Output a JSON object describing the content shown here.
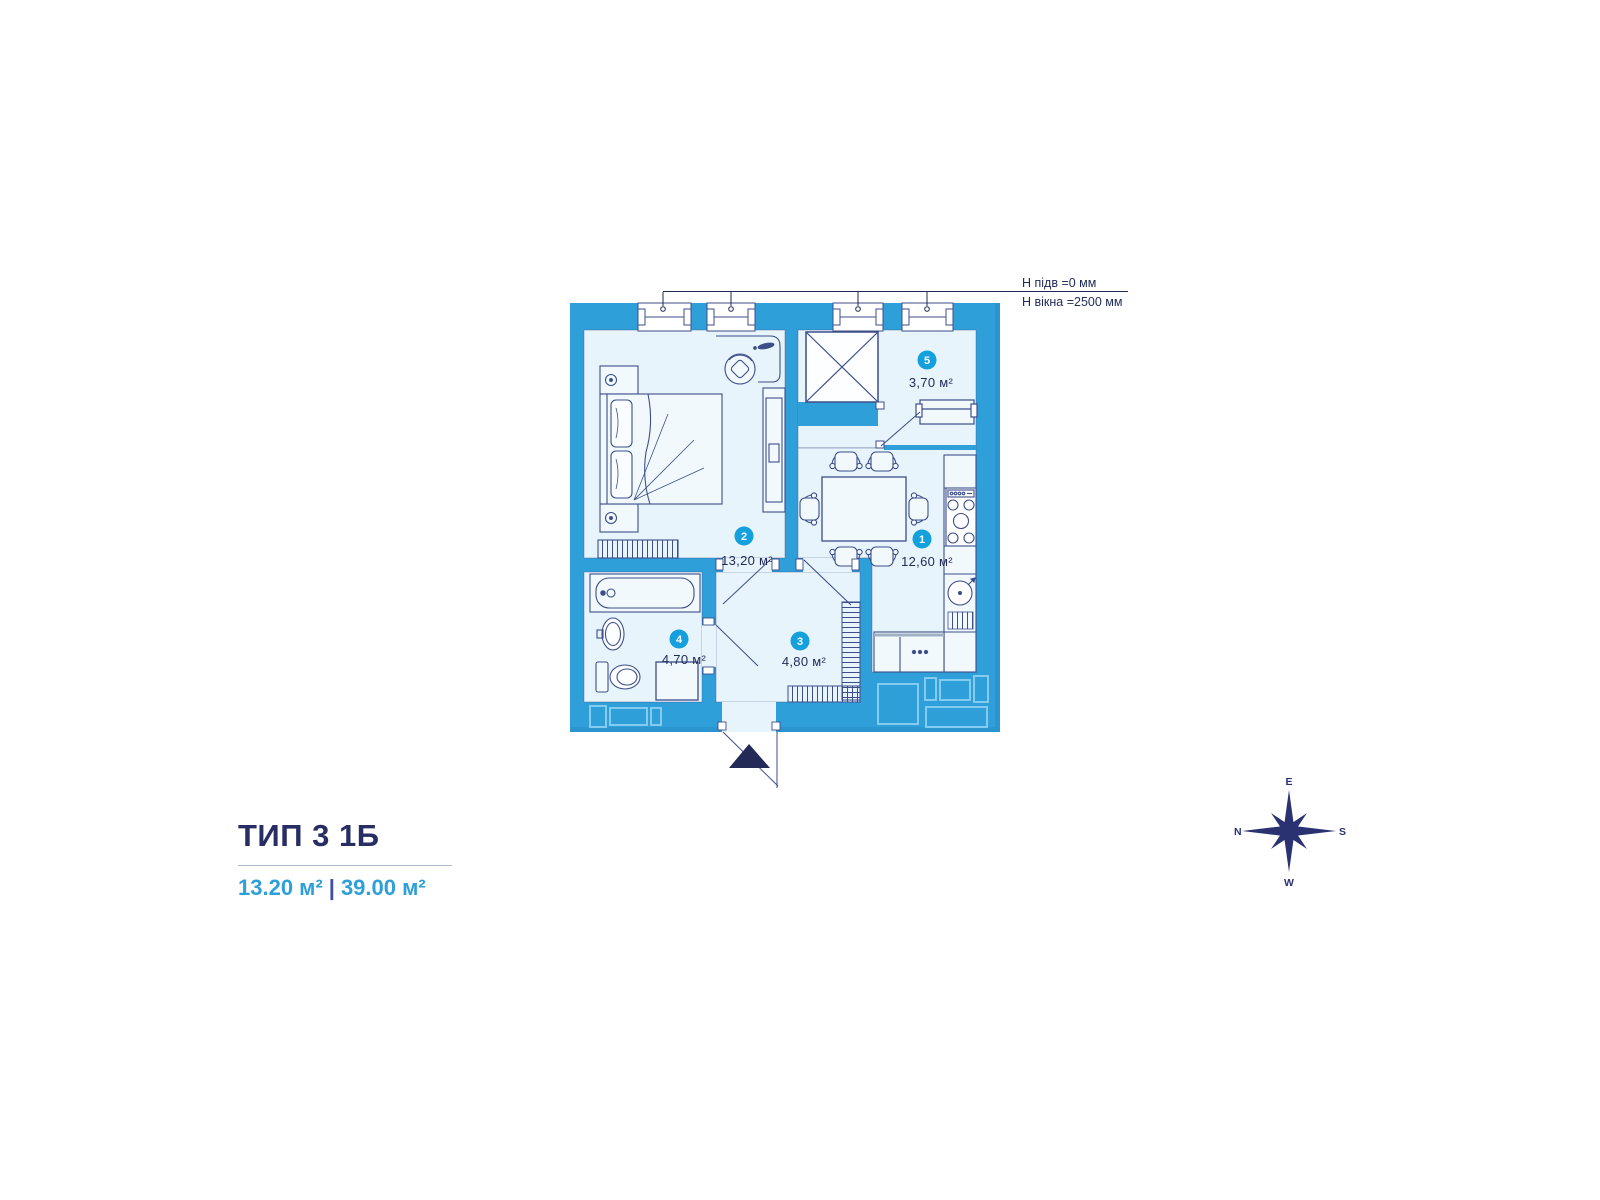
{
  "title": {
    "name": "ТИП 3 1Б",
    "area_living": "13.20 м²",
    "divider": "|",
    "area_total": "39.00 м²"
  },
  "annotations": {
    "floor_height": "Н підв =0 мм",
    "window_height": "Н вікна =2500 мм"
  },
  "rooms": [
    {
      "id": "1",
      "area": "12,60 м²"
    },
    {
      "id": "2",
      "area": "13,20 м²"
    },
    {
      "id": "3",
      "area": "4,80 м²"
    },
    {
      "id": "4",
      "area": "4,70 м²"
    },
    {
      "id": "5",
      "area": "3,70 м²"
    }
  ],
  "compass": {
    "top": "E",
    "left": "N",
    "right": "S",
    "bottom": "W"
  },
  "colors": {
    "wall": "#2F9FD9",
    "floor": "#E8F4FB",
    "line": "#3D4E8A",
    "badge": "#14A0DC",
    "text": "#1F2A56",
    "accent": "#2D9FD9",
    "title": "#282E63",
    "entrance_arrow": "#232A56"
  }
}
